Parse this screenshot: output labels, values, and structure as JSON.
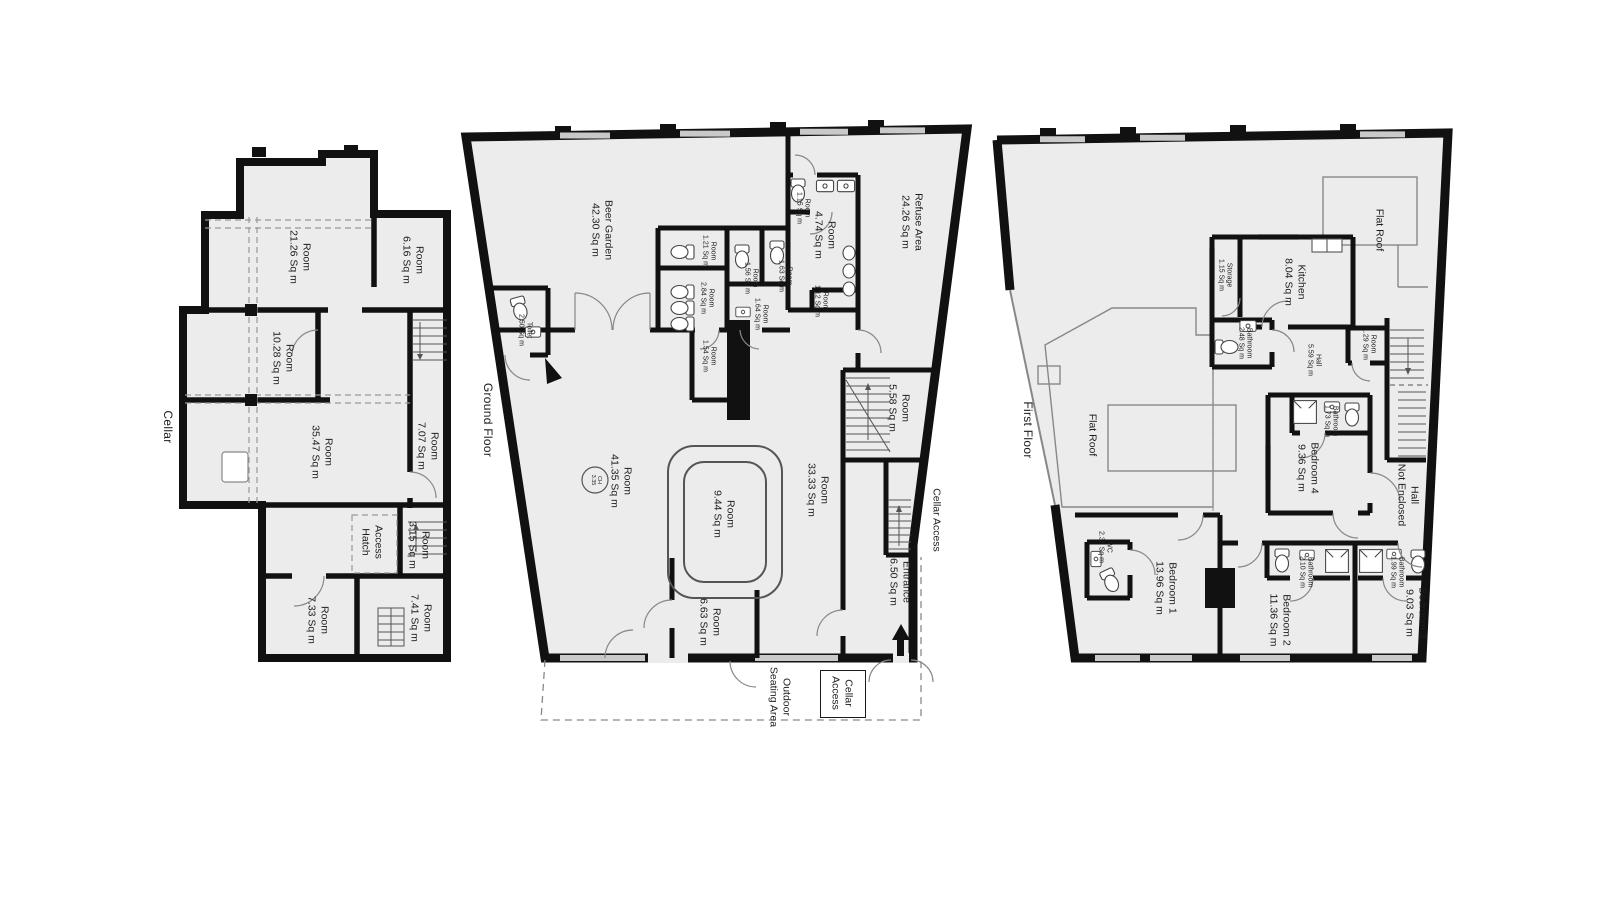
{
  "floors": {
    "cellar": {
      "label": "Cellar",
      "rooms": {
        "r2126": {
          "name": "Room",
          "area": "21.26 Sq m"
        },
        "r616": {
          "name": "Room",
          "area": "6.16 Sq m"
        },
        "r1028": {
          "name": "Room",
          "area": "10.28 Sq m"
        },
        "r3547": {
          "name": "Room",
          "area": "35.47 Sq m"
        },
        "r707": {
          "name": "Room",
          "area": "7.07 Sq m"
        },
        "hatch": {
          "name": "Access",
          "area": "Hatch"
        },
        "r315": {
          "name": "Room",
          "area": "3.15 Sq m"
        },
        "r733": {
          "name": "Room",
          "area": "7.33 Sq m"
        },
        "r741": {
          "name": "Room",
          "area": "7.41 Sq m"
        }
      }
    },
    "ground": {
      "label": "Ground Floor",
      "rooms": {
        "beer_garden": {
          "name": "Beer Garden",
          "area": "42.30 Sq m"
        },
        "toilet": {
          "name": "Toilet",
          "area": "2.50 Sq m"
        },
        "r115": {
          "name": "Room",
          "area": "1.15 Sq m"
        },
        "r474": {
          "name": "Room",
          "area": "4.74 Sq m"
        },
        "r121": {
          "name": "Room",
          "area": "1.21 Sq m"
        },
        "r156": {
          "name": "Room",
          "area": "1.56 Sq m"
        },
        "r163": {
          "name": "Room",
          "area": "1.63 Sq m"
        },
        "r284": {
          "name": "Room",
          "area": "2.84 Sq m"
        },
        "r164": {
          "name": "Room",
          "area": "1.64 Sq m"
        },
        "r112": {
          "name": "Room",
          "area": "1.12 Sq m"
        },
        "r154": {
          "name": "Room",
          "area": "1.54 Sq m"
        },
        "refuse": {
          "name": "Refuse Area",
          "area": "24.26 Sq m"
        },
        "r558": {
          "name": "Room",
          "area": "5.58 Sq m"
        },
        "r4135": {
          "name": "Room",
          "area": "41.35 Sq m"
        },
        "ch": {
          "name": "CH",
          "area": "3.35"
        },
        "r944": {
          "name": "Room",
          "area": "9.44 Sq m"
        },
        "r3333": {
          "name": "Room",
          "area": "33.33 Sq m"
        },
        "r663": {
          "name": "Room",
          "area": "6.63 Sq m"
        },
        "entrance": {
          "name": "Entrance",
          "area": "6.50 Sq m"
        },
        "cellar_access_side": {
          "label": "Cellar Access"
        },
        "outdoor": {
          "name": "Outdoor",
          "area": "Seating Area"
        },
        "cellar_access_box": {
          "name": "Cellar",
          "area": "Access"
        }
      }
    },
    "first": {
      "label": "First Floor",
      "rooms": {
        "flat_roof_top": {
          "label": "Flat Roof"
        },
        "flat_roof_left": {
          "label": "Flat Roof"
        },
        "kitchen": {
          "name": "Kitchen",
          "area": "8.04 Sq m"
        },
        "storage": {
          "name": "Storage",
          "area": "1.15 Sq m"
        },
        "bath248": {
          "name": "Bathroom",
          "area": "2.48 Sq m"
        },
        "hall559": {
          "name": "Hall",
          "area": "5.59 Sq m"
        },
        "r129": {
          "name": "Room",
          "area": "1.29 Sq m"
        },
        "bath173": {
          "name": "Bathroom",
          "area": "1.73 Sq m"
        },
        "bed4": {
          "name": "Bedroom 4",
          "area": "9.36 Sq m"
        },
        "hall_ne": {
          "name": "Hall",
          "area": "Not Enclosed"
        },
        "wc": {
          "name": "WC",
          "area": "2.36 Sq m"
        },
        "bed1": {
          "name": "Bedroom 1",
          "area": "13.96 Sq m"
        },
        "bed2": {
          "name": "Bedroom 2",
          "area": "11.36 Sq m"
        },
        "bath210": {
          "name": "Bathroom",
          "area": "2.10 Sq m"
        },
        "bed3": {
          "name": "Bedroom 3",
          "area": "9.03 Sq m"
        },
        "bath199": {
          "name": "Bathroom",
          "area": "1.99 Sq m"
        }
      }
    }
  }
}
